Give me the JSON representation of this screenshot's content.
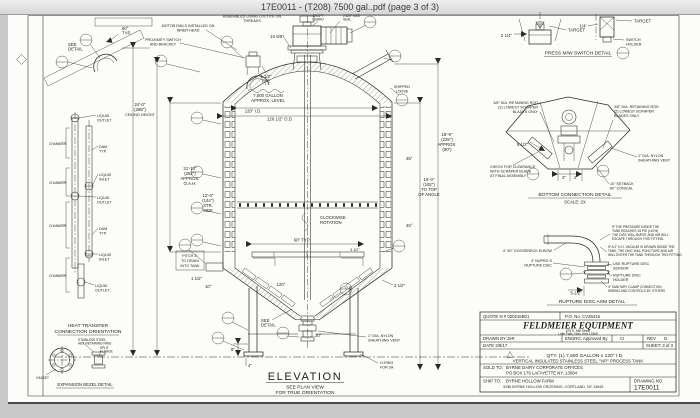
{
  "window": {
    "title": "17E0011 - (T208) 7500 gal..pdf (page 3 of 3)"
  },
  "top": {
    "loctite": [
      "ASSEMBLED USING LOCTITE ON",
      "THREADS"
    ],
    "motor_rails": [
      "MOTOR RAILS INSTALLED ON",
      "INNER HEAD"
    ],
    "proximity": [
      "PROXIMITY SWITCH",
      "AND BRACKET"
    ],
    "shaft_guard": [
      "SHAFT",
      "GUARD"
    ],
    "seal": [
      "2.625\" MSS",
      "SEAL"
    ],
    "dim_10_5_8": "10 5/8\"",
    "dim_1_1_2_typ": [
      "1 1/2\"",
      "TYP."
    ],
    "dim_60_typ": [
      "60°",
      "TYP."
    ],
    "see_detail": [
      "SEE",
      "DETAIL"
    ],
    "shipped_loose": [
      "SHIPPED",
      "LOOSE"
    ]
  },
  "left_dims": {
    "ceiling": [
      "24'-0\"",
      "(288\")",
      "CEILING HEIGHT"
    ],
    "oah": [
      "21'-10\"",
      "(252\")",
      "APPROX.",
      "O.A.H."
    ],
    "straight_side": [
      "12'-0\"",
      "(144\")",
      "STR.",
      "SIDE"
    ]
  },
  "right_dims": {
    "approx": [
      "18'-9\"",
      "(225\")",
      "APPROX.",
      "(90\")"
    ],
    "top_of_angle": [
      "16'-0\"",
      "(192\")",
      "TO TOP",
      "OF ANGLE"
    ],
    "angle_a": "45°",
    "angle_b": "45°",
    "dim_3_1_2": "3 1/2\""
  },
  "tank": {
    "level": [
      "7,500 GALLON",
      "APPROX. LEVEL"
    ],
    "id": "120\" I.D.",
    "od": "126 1/2\" O.D.",
    "rotation": [
      "CLOCKWISE",
      "ROTATION"
    ],
    "sweep": "60\" TYP.",
    "bracket": "3 1/2\"",
    "cone_angle": "120°",
    "pitch": [
      "PITCH 2\"",
      "TO DRAIN",
      "INTO TANK"
    ],
    "dim_1_1_2": "1 1/2\"",
    "dim_10deg": "10°",
    "see_detail": [
      "SEE",
      "DETAIL"
    ],
    "leg_dim": "30\"",
    "dim_8": "8\"",
    "dim_4": "4\"",
    "vent": [
      "1\" DIA. NYLON",
      "SHEATHING VENT"
    ],
    "oring": [
      "O-RING",
      "FOR 3A"
    ]
  },
  "heat": {
    "title": [
      "HEAT TRANSFER",
      "CONNECTION ORIENTATION"
    ],
    "channels": "CHANNELS",
    "liquid_outlet": [
      "LIQUID",
      "OUTLET"
    ],
    "dam": [
      "DAM",
      "TYP."
    ],
    "liquid_inlet": [
      "LIQUID",
      "INLET"
    ],
    "bezel_note_a": [
      "STAINLESS STEEL",
      "HEX RETAINING RING"
    ],
    "bezel_note_b": [
      "SPLIT",
      "FLANGE"
    ],
    "bezel_note_c": "GASKET",
    "bezel_title": "EXPANSION BEZEL DETAIL"
  },
  "press": {
    "title": "PRESS M/W SWITCH DETAIL",
    "dim_2_1_4": "2 1/4\"",
    "dim_1_4": "1/4\"",
    "target_a": "TARGET",
    "target_b": "TARGET",
    "holder": [
      "SWITCH",
      "HOLDER"
    ]
  },
  "bottom_conn": {
    "rod_left": [
      "3/8\" DIA. RETAINING ROD",
      "(2) LOWEST SCRAPER",
      "BLADES ONLY"
    ],
    "rod_right": [
      "3/8\" DIA. RETAINING ROD",
      "(2) LOWEST SCRAPER",
      "BLADES ONLY"
    ],
    "dim_5_1_2": "5 1/2\"",
    "clearance": [
      "CHECK FOR CLEARANCE",
      "WITH SCRAPER BLADE",
      "AT FINAL ASSEMBLY"
    ],
    "vent": [
      "1\" DIA. NYLON",
      "SHEATHING VENT"
    ],
    "setback": [
      "10\" SETBACK",
      "60° CONICAL"
    ],
    "dim_2a": "2\"",
    "dim_2b": "2\"",
    "title": "BOTTOM CONNECTION DETAIL",
    "scale": "SCALE: 2X"
  },
  "rupture": {
    "note1": [
      "IF THE PRESSURE INSIDE THE",
      "TANK REACHES 15 PSI (±10%)",
      "THE DISC WILL BURST AND AIR WILL",
      "ESCAPE THROUGH THIS FITTING."
    ],
    "note2": [
      "IF A 2\" H.G. VACUUM IS DRAWN INSIDE THE",
      "TANK, THE DISC WILL PUNCTURE AND AIR",
      "WILL ENTER THE TANK THROUGH THIS FITTING."
    ],
    "gooseneck": "4\" 90° GOOSENECK ELBOW",
    "disc": [
      "4\" NUPRO S",
      "RUPTURE DISC"
    ],
    "sensor": [
      "USE RUPTURE DISC",
      "SENSOR"
    ],
    "holder": [
      "RUPTURE DISC",
      "HOLDER"
    ],
    "clamp": [
      "4\" SANITARY CLAMP CONNECTION",
      "WIRING AND CONTROLS BY OTHERS"
    ],
    "dim_5_1_2": "5-1/2\"",
    "title": "RUPTURE DISC ASM DETAIL"
  },
  "elevation": {
    "title": "ELEVATION",
    "sub1": "SEE PLAN VIEW",
    "sub2": "FOR TRUE ORIENTATION"
  },
  "title_block": {
    "quote": "QUOTE N # 020216B01",
    "po": "P.O. No. CV26415",
    "company": "FELDMEIER EQUIPMENT",
    "addr1": "679 E. Mill Street",
    "addr2": "Little Falls, New York 13365",
    "drawn": "DRAWN BY:JeR",
    "engrg": "ENGRG. Approved By",
    "ci": "CI",
    "rev_label": "REV",
    "rev": "D",
    "date": "DATE 2/8/17",
    "sheet": "SHEET: 3 of 3",
    "qty": "QTY. (1)  7,500 GALLON x 120\" I.D.",
    "desc": "VERTICAL INSULATED STAINLESS STEEL \"VIP\" PROCESS TANK",
    "sold_label": "SOLD TO:",
    "sold1": "BYRNE DAIRY CORPORATE OFFICES",
    "sold2": "PO BOX 176 LAFAYETTE NY, 13084",
    "ship_label": "SHIP TO:",
    "ship1": "BYRNE HOLLOW FARM",
    "ship2": "3156 BYRNE HOLLOW CROSSING, CORTLAND, NY 13045",
    "dwg_label": "DRAWING NO.",
    "dwg_no": "17E0011"
  }
}
